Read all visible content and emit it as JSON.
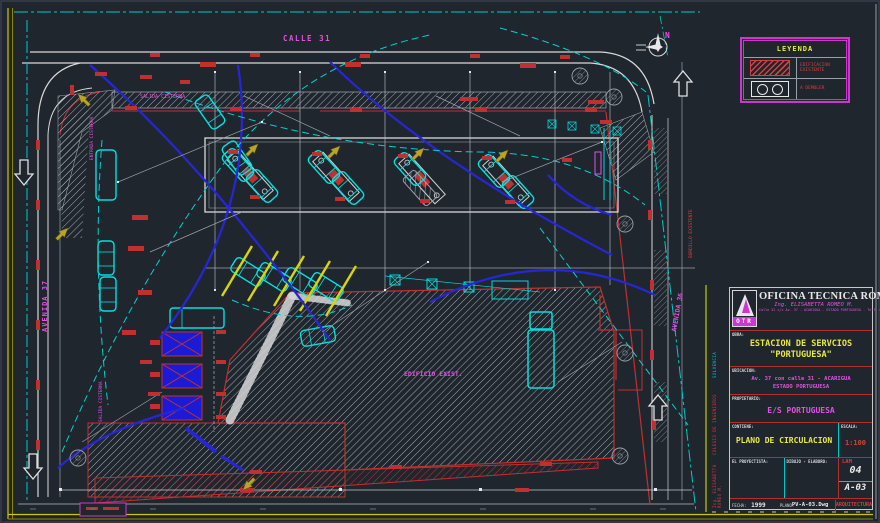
{
  "sheet": {
    "road_top": "CALLE 31",
    "road_left": "AVENIDA 37",
    "road_right": "AVENIDA 36",
    "north_letter": "N",
    "ann_salida_cisterna": "SALIDA CISTERNA",
    "ann_entrada_cisterna": "ENTRADA CISTERNA",
    "ann_edificio": "EDIFICIO EXIST.",
    "ann_bordillo": "BORDILLO EXISTENTE"
  },
  "legend": {
    "title": "LEYENDA",
    "item1": "EDIFICACION EXISTENTE",
    "item2": "A DEMOLER"
  },
  "title_block": {
    "company": "OFICINA TECNICA ROMEO",
    "logo": "OTR",
    "engineer": "Ing. ELISABETTA ROMEO M.",
    "address": "Calle 31 c/c Av. 37 - ACARIGUA - ESTADO PORTUGUESA - Telf. 045-41.22.22",
    "labels": {
      "obra": "OBRA:",
      "ubicacion": "UBICACION:",
      "propietario": "PROPIETARIO:",
      "contiene": "CONTIENE:",
      "escala": "ESCALA:",
      "proyectista": "EL PROYECTISTA:",
      "dibujo": "DIBUJO - ELABORO:",
      "fecha": "FECHA:",
      "plano": "PLANO:",
      "lam": "LAM"
    },
    "obra_line1": "ESTACION DE SERVCIOS",
    "obra_line2": "\"PORTUGUESA\"",
    "ubicacion_line1": "Av. 37 con calle 31 - ACARIGUA",
    "ubicacion_line2": "ESTADO PORTUGUESA",
    "propietario": "E/S PORTUGUESA",
    "contiene": "PLANO DE CIRCULACION",
    "escala": "1:100",
    "lam_no": "04",
    "sheet_no": "A-03",
    "fecha": "1999",
    "file": "PV-A-03.Dwg",
    "discipline": "ARQUITECTURA",
    "side_solvencia": "SOLVENCIA",
    "side_colegio": "COLEGIO DE INGENIEROS",
    "side_ing": "Ing. ELISABETTA ROMEO M."
  }
}
